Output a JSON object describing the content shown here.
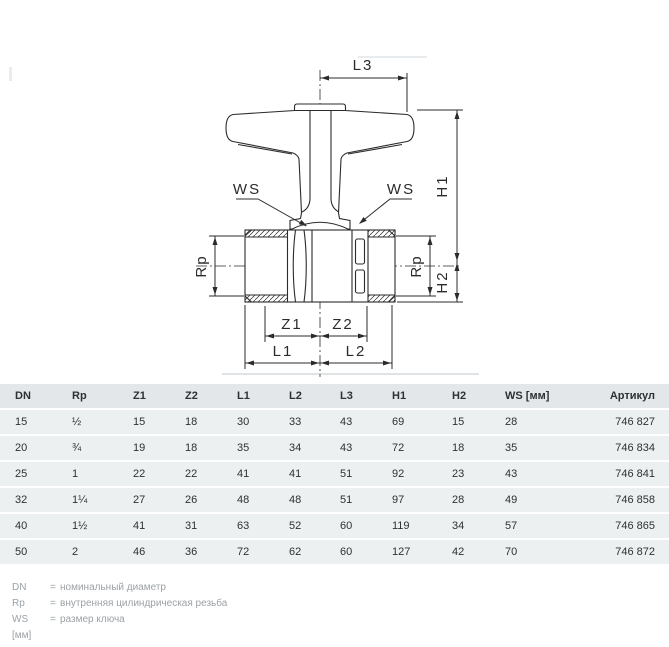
{
  "drawing": {
    "dim_labels": {
      "l3": "L3",
      "h1": "H1",
      "h2": "H2",
      "ws_left": "WS",
      "ws_right": "WS",
      "rp_left": "Rp",
      "rp_right": "Rp",
      "z1": "Z1",
      "z2": "Z2",
      "l1": "L1",
      "l2": "L2"
    }
  },
  "table": {
    "columns": [
      "DN",
      "Rp",
      "Z1",
      "Z2",
      "L1",
      "L2",
      "L3",
      "H1",
      "H2",
      "WS [мм]",
      "Артикул"
    ],
    "rows": [
      [
        "15",
        "½",
        "15",
        "18",
        "30",
        "33",
        "43",
        "69",
        "15",
        "28",
        "746 827"
      ],
      [
        "20",
        "¾",
        "19",
        "18",
        "35",
        "34",
        "43",
        "72",
        "18",
        "35",
        "746 834"
      ],
      [
        "25",
        "1",
        "22",
        "22",
        "41",
        "41",
        "51",
        "92",
        "23",
        "43",
        "746 841"
      ],
      [
        "32",
        "1¼",
        "27",
        "26",
        "48",
        "48",
        "51",
        "97",
        "28",
        "49",
        "746 858"
      ],
      [
        "40",
        "1½",
        "41",
        "31",
        "63",
        "52",
        "60",
        "119",
        "34",
        "57",
        "746 865"
      ],
      [
        "50",
        "2",
        "46",
        "36",
        "72",
        "62",
        "60",
        "127",
        "42",
        "70",
        "746 872"
      ]
    ]
  },
  "legend": {
    "items": [
      {
        "term": "DN",
        "eq": "=",
        "def": "номинальный диаметр"
      },
      {
        "term": "Rp",
        "eq": "=",
        "def": "внутренняя цилиндрическая резьба"
      },
      {
        "term": "WS [мм]",
        "eq": "=",
        "def": "размер ключа"
      }
    ]
  },
  "colors": {
    "drawing_line": "#2b2b2b",
    "table_header_bg": "#e4e7e9",
    "table_row_bg": "#edf0f1",
    "legend_text": "#9ba2a6"
  }
}
